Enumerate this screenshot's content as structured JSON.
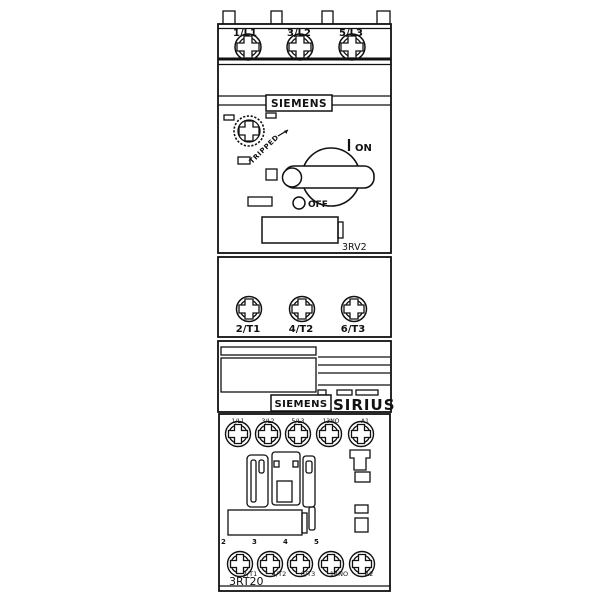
{
  "colors": {
    "line": "#111111",
    "background": "#ffffff"
  },
  "breaker": {
    "brand": "SIEMENS",
    "model": "3RV2",
    "line_terminals": [
      "1/L1",
      "3/L2",
      "5/L3"
    ],
    "load_terminals": [
      "2/T1",
      "4/T2",
      "6/T3"
    ],
    "switch": {
      "tripped_label": "TRIPPED",
      "on_label": "ON",
      "off_label": "OFF"
    }
  },
  "adapter": {
    "brand": "SIEMENS",
    "series": "SIRIUS"
  },
  "contactor": {
    "model": "3RT20",
    "top_terminals": [
      "1/L1",
      "3/L2",
      "5/L3",
      "13NO",
      "A1"
    ],
    "bottom_markers": [
      "2",
      "3",
      "4",
      "5"
    ],
    "bottom_terminals": [
      "2/T1",
      "4/T2",
      "6/T3",
      "14NO",
      "A2"
    ]
  }
}
